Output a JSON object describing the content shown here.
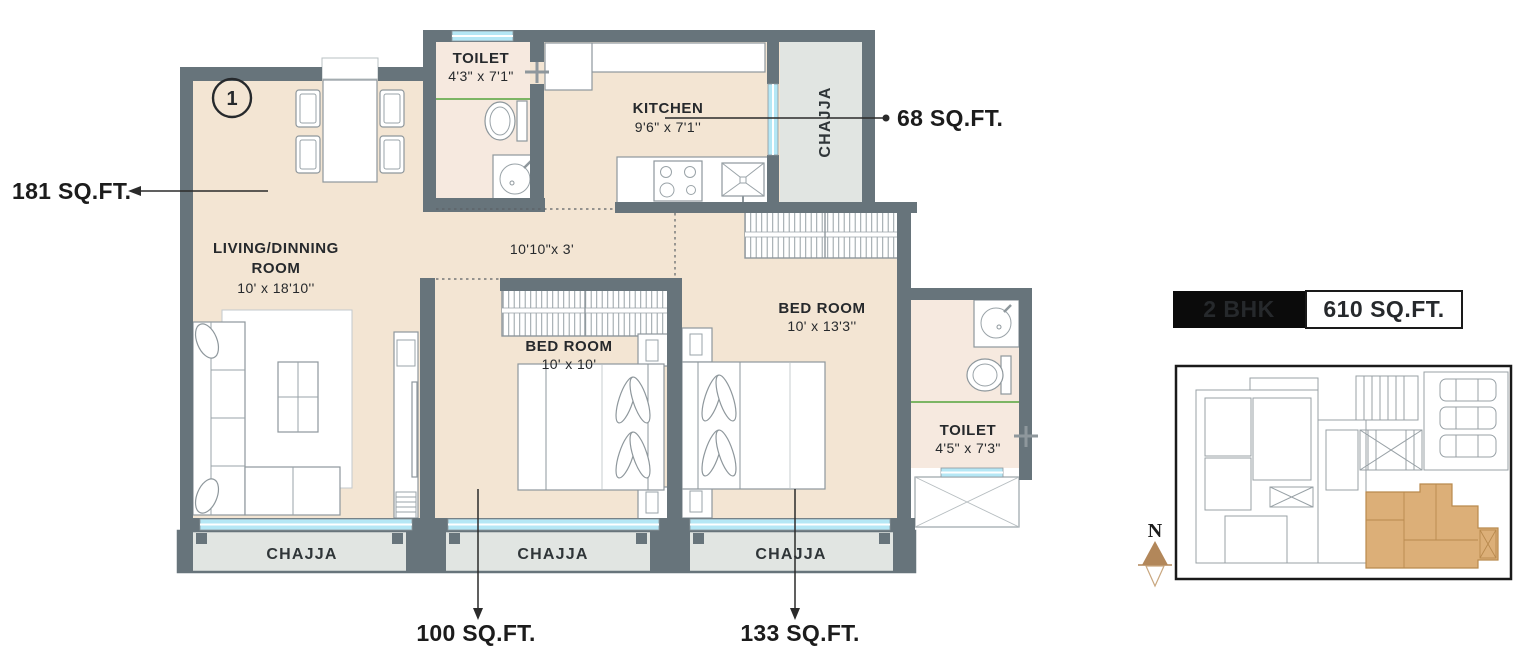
{
  "plan": {
    "unit_marker": "1",
    "rooms": {
      "living": {
        "name_line1": "LIVING/DINNING",
        "name_line2": "ROOM",
        "dims": "10' x 18'10''"
      },
      "toilet1": {
        "name": "TOILET",
        "dims": "4'3\" x 7'1\""
      },
      "kitchen": {
        "name": "KITCHEN",
        "dims": "9'6\" x 7'1''"
      },
      "bedroom1": {
        "name": "BED ROOM",
        "dims": "10' x 10'"
      },
      "bedroom2": {
        "name": "BED ROOM",
        "dims": "10' x 13'3''"
      },
      "toilet2": {
        "name": "TOILET",
        "dims": "4'5\" x 7'3\""
      },
      "passage_dims": "10'10\"x 3'",
      "chajja_top": "CHAJJA",
      "chajja_left": "CHAJJA",
      "chajja_mid": "CHAJJA",
      "chajja_right": "CHAJJA"
    },
    "callouts": {
      "living": "181 SQ.FT.",
      "kitchen": "68 SQ.FT.",
      "bedroom1": "100 SQ.FT.",
      "bedroom2": "133 SQ.FT."
    }
  },
  "info": {
    "unit_type": "2 BHK",
    "unit_area": "610 SQ.FT.",
    "north_label": "N"
  },
  "colors": {
    "wall": "#67747b",
    "floor": "#f3e5d3",
    "toilet_floor": "#f6e9df",
    "chajja": "#e1e5e2",
    "window_glass": "#b5e7f5",
    "partition_green": "#7cb564",
    "keyplan_highlight": "#dcaf78",
    "north_arrow": "#b2875a",
    "badge_bg": "#0b0b0b",
    "text": "#26292c"
  }
}
